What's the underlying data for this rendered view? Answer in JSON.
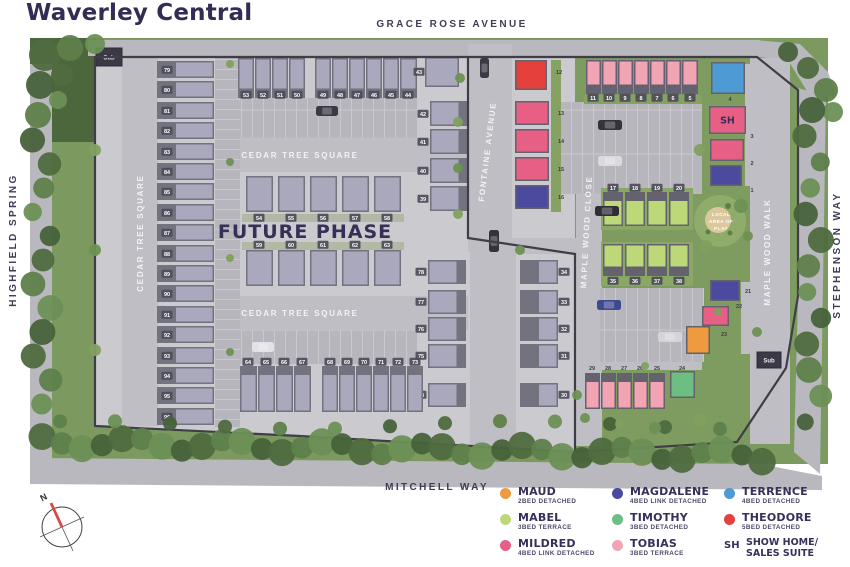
{
  "title": "Waverley Central",
  "streets": {
    "grace": "GRACE ROSE AVENUE",
    "highfield": "HIGHFIELD SPRING",
    "stephenson": "STEPHENSON WAY",
    "mitchell": "MITCHELL WAY",
    "fontaine": "FONTAINE AVENUE",
    "maple_close": "MAPLE WOOD CLOSE",
    "maple_walk": "MAPLE WOOD WALK",
    "cedar_top": "CEDAR TREE SQUARE",
    "cedar_bottom": "CEDAR TREE SQUARE",
    "cedar_left": "CEDAR TREE SQUARE"
  },
  "labels": {
    "future_phase": "FUTURE PHASE",
    "play_1": "LOCAL",
    "play_2": "AREA OF",
    "play_3": "PLAY",
    "sub": "Sub",
    "north": "N",
    "show_home": "SH"
  },
  "house_types": {
    "maud": "#EF9A3F",
    "mabel": "#BCD879",
    "mildred": "#E75F85",
    "magdalene": "#4B4A9E",
    "timothy": "#6DBE83",
    "tobias": "#F2A4B4",
    "terrence": "#4E9AD5",
    "theodore": "#E6403C",
    "showhome": "#E75F85",
    "future": "#A9A8BC"
  },
  "legend": {
    "items": [
      {
        "swatch": "#EF9A3F",
        "name": "MAUD",
        "desc": "2BED DETACHED"
      },
      {
        "swatch": "#BCD879",
        "name": "MABEL",
        "desc": "3BED TERRACE"
      },
      {
        "swatch": "#E75F85",
        "name": "MILDRED",
        "desc": "4BED LINK DETACHED"
      },
      {
        "swatch": "#4B4A9E",
        "name": "MAGDALENE",
        "desc": "4BED LINK DETACHED"
      },
      {
        "swatch": "#6DBE83",
        "name": "TIMOTHY",
        "desc": "3BED DETACHED"
      },
      {
        "swatch": "#F2A4B4",
        "name": "TOBIAS",
        "desc": "3BED TERRACE"
      },
      {
        "swatch": "#4E9AD5",
        "name": "TERRENCE",
        "desc": "4BED DETACHED"
      },
      {
        "swatch": "#E6403C",
        "name": "THEODORE",
        "desc": "5BED DETACHED"
      },
      {
        "symbol": "SH",
        "name": "SHOW HOME/",
        "name2": "SALES SUITE"
      }
    ]
  },
  "plots": [
    {
      "n": "12",
      "t": "theodore",
      "x": 515,
      "y": 60,
      "w": 32,
      "h": 30,
      "lx": 559,
      "ly": 74,
      "lc": "d"
    },
    {
      "n": "13",
      "t": "mildred",
      "x": 515,
      "y": 101,
      "w": 34,
      "h": 24,
      "lx": 561,
      "ly": 115,
      "lc": "d"
    },
    {
      "n": "14",
      "t": "mildred",
      "x": 515,
      "y": 129,
      "w": 34,
      "h": 24,
      "lx": 561,
      "ly": 143,
      "lc": "d"
    },
    {
      "n": "15",
      "t": "mildred",
      "x": 515,
      "y": 157,
      "w": 34,
      "h": 24,
      "lx": 561,
      "ly": 171,
      "lc": "d"
    },
    {
      "n": "16",
      "t": "magdalene",
      "x": 515,
      "y": 185,
      "w": 34,
      "h": 24,
      "lx": 561,
      "ly": 199,
      "lc": "d"
    },
    {
      "n": "11",
      "t": "tobias",
      "x": 586,
      "y": 60,
      "w": 15,
      "h": 34,
      "f": "s",
      "lx": 593,
      "ly": 100,
      "lc": "l"
    },
    {
      "n": "10",
      "t": "tobias",
      "x": 602,
      "y": 60,
      "w": 15,
      "h": 34,
      "f": "s",
      "lx": 609,
      "ly": 100,
      "lc": "l"
    },
    {
      "n": "9",
      "t": "tobias",
      "x": 618,
      "y": 60,
      "w": 15,
      "h": 34,
      "f": "s",
      "lx": 625,
      "ly": 100,
      "lc": "l"
    },
    {
      "n": "8",
      "t": "tobias",
      "x": 634,
      "y": 60,
      "w": 15,
      "h": 34,
      "f": "s",
      "lx": 641,
      "ly": 100,
      "lc": "l"
    },
    {
      "n": "7",
      "t": "tobias",
      "x": 650,
      "y": 60,
      "w": 15,
      "h": 34,
      "f": "s",
      "lx": 657,
      "ly": 100,
      "lc": "l"
    },
    {
      "n": "6",
      "t": "tobias",
      "x": 666,
      "y": 60,
      "w": 15,
      "h": 34,
      "f": "s",
      "lx": 673,
      "ly": 100,
      "lc": "l"
    },
    {
      "n": "5",
      "t": "tobias",
      "x": 682,
      "y": 60,
      "w": 16,
      "h": 34,
      "f": "s",
      "lx": 690,
      "ly": 100,
      "lc": "l"
    },
    {
      "n": "4",
      "t": "terrence",
      "x": 711,
      "y": 62,
      "w": 34,
      "h": 32,
      "lx": 730,
      "ly": 101,
      "lc": "d"
    },
    {
      "n": "3",
      "t": "showhome",
      "x": 709,
      "y": 106,
      "w": 37,
      "h": 28,
      "sh": 1,
      "lx": 752,
      "ly": 138,
      "lc": "d"
    },
    {
      "n": "2",
      "t": "mildred",
      "x": 710,
      "y": 139,
      "w": 34,
      "h": 22,
      "lx": 752,
      "ly": 165,
      "lc": "d"
    },
    {
      "n": "1",
      "t": "magdalene",
      "x": 710,
      "y": 165,
      "w": 32,
      "h": 21,
      "lx": 752,
      "ly": 192,
      "lc": "d"
    },
    {
      "n": "17",
      "t": "mabel",
      "x": 603,
      "y": 192,
      "w": 20,
      "h": 34,
      "f": "n",
      "lx": 613,
      "ly": 190,
      "lc": "l"
    },
    {
      "n": "18",
      "t": "mabel",
      "x": 625,
      "y": 192,
      "w": 20,
      "h": 34,
      "f": "n",
      "lx": 635,
      "ly": 190,
      "lc": "l"
    },
    {
      "n": "19",
      "t": "mabel",
      "x": 647,
      "y": 192,
      "w": 20,
      "h": 34,
      "f": "n",
      "lx": 657,
      "ly": 190,
      "lc": "l"
    },
    {
      "n": "20",
      "t": "mabel",
      "x": 669,
      "y": 192,
      "w": 20,
      "h": 34,
      "f": "n",
      "lx": 679,
      "ly": 190,
      "lc": "l"
    },
    {
      "n": "35",
      "t": "mabel",
      "x": 603,
      "y": 244,
      "w": 20,
      "h": 32,
      "f": "s",
      "lx": 613,
      "ly": 283,
      "lc": "l"
    },
    {
      "n": "36",
      "t": "mabel",
      "x": 625,
      "y": 244,
      "w": 20,
      "h": 32,
      "f": "s",
      "lx": 635,
      "ly": 283,
      "lc": "l"
    },
    {
      "n": "37",
      "t": "mabel",
      "x": 647,
      "y": 244,
      "w": 20,
      "h": 32,
      "f": "s",
      "lx": 657,
      "ly": 283,
      "lc": "l"
    },
    {
      "n": "38",
      "t": "mabel",
      "x": 669,
      "y": 244,
      "w": 20,
      "h": 32,
      "f": "s",
      "lx": 679,
      "ly": 283,
      "lc": "l"
    },
    {
      "n": "21",
      "t": "magdalene",
      "x": 710,
      "y": 280,
      "w": 30,
      "h": 21,
      "lx": 748,
      "ly": 293,
      "lc": "d"
    },
    {
      "n": "22",
      "t": "mildred",
      "x": 702,
      "y": 306,
      "w": 27,
      "h": 20,
      "lx": 739,
      "ly": 308,
      "lc": "d"
    },
    {
      "n": "23",
      "t": "maud",
      "x": 686,
      "y": 326,
      "w": 24,
      "h": 28,
      "lx": 724,
      "ly": 336,
      "lc": "d"
    },
    {
      "n": "24",
      "t": "timothy",
      "x": 670,
      "y": 371,
      "w": 25,
      "h": 27,
      "lx": 682,
      "ly": 370,
      "lc": "d"
    },
    {
      "n": "29",
      "t": "tobias",
      "x": 585,
      "y": 373,
      "w": 15,
      "h": 36,
      "f": "n",
      "lx": 592,
      "ly": 370,
      "lc": "d"
    },
    {
      "n": "28",
      "t": "tobias",
      "x": 601,
      "y": 373,
      "w": 15,
      "h": 36,
      "f": "n",
      "lx": 608,
      "ly": 370,
      "lc": "d"
    },
    {
      "n": "27",
      "t": "tobias",
      "x": 617,
      "y": 373,
      "w": 15,
      "h": 36,
      "f": "n",
      "lx": 624,
      "ly": 370,
      "lc": "d"
    },
    {
      "n": "26",
      "t": "tobias",
      "x": 633,
      "y": 373,
      "w": 15,
      "h": 36,
      "f": "n",
      "lx": 640,
      "ly": 370,
      "lc": "d"
    },
    {
      "n": "25",
      "t": "tobias",
      "x": 649,
      "y": 373,
      "w": 16,
      "h": 36,
      "f": "n",
      "lx": 657,
      "ly": 370,
      "lc": "d"
    },
    {
      "n": "79",
      "t": "future",
      "x": 157,
      "y": 61,
      "w": 57,
      "h": 17,
      "f": "w",
      "lx": 167,
      "ly": 72,
      "lc": "l"
    },
    {
      "n": "80",
      "t": "future",
      "x": 157,
      "y": 81,
      "w": 57,
      "h": 17,
      "f": "w",
      "lx": 167,
      "ly": 92,
      "lc": "l"
    },
    {
      "n": "81",
      "t": "future",
      "x": 157,
      "y": 102,
      "w": 57,
      "h": 17,
      "f": "w",
      "lx": 167,
      "ly": 113,
      "lc": "l"
    },
    {
      "n": "82",
      "t": "future",
      "x": 157,
      "y": 122,
      "w": 57,
      "h": 17,
      "f": "w",
      "lx": 167,
      "ly": 133,
      "lc": "l"
    },
    {
      "n": "83",
      "t": "future",
      "x": 157,
      "y": 143,
      "w": 57,
      "h": 17,
      "f": "w",
      "lx": 167,
      "ly": 154,
      "lc": "l"
    },
    {
      "n": "84",
      "t": "future",
      "x": 157,
      "y": 163,
      "w": 57,
      "h": 17,
      "f": "w",
      "lx": 167,
      "ly": 174,
      "lc": "l"
    },
    {
      "n": "85",
      "t": "future",
      "x": 157,
      "y": 183,
      "w": 57,
      "h": 17,
      "f": "w",
      "lx": 167,
      "ly": 194,
      "lc": "l"
    },
    {
      "n": "86",
      "t": "future",
      "x": 157,
      "y": 204,
      "w": 57,
      "h": 17,
      "f": "w",
      "lx": 167,
      "ly": 215,
      "lc": "l"
    },
    {
      "n": "87",
      "t": "future",
      "x": 157,
      "y": 224,
      "w": 57,
      "h": 17,
      "f": "w",
      "lx": 167,
      "ly": 235,
      "lc": "l"
    },
    {
      "n": "88",
      "t": "future",
      "x": 157,
      "y": 245,
      "w": 57,
      "h": 17,
      "f": "w",
      "lx": 167,
      "ly": 256,
      "lc": "l"
    },
    {
      "n": "89",
      "t": "future",
      "x": 157,
      "y": 265,
      "w": 57,
      "h": 17,
      "f": "w",
      "lx": 167,
      "ly": 276,
      "lc": "l"
    },
    {
      "n": "90",
      "t": "future",
      "x": 157,
      "y": 285,
      "w": 57,
      "h": 17,
      "f": "w",
      "lx": 167,
      "ly": 296,
      "lc": "l"
    },
    {
      "n": "91",
      "t": "future",
      "x": 157,
      "y": 306,
      "w": 57,
      "h": 17,
      "f": "w",
      "lx": 167,
      "ly": 317,
      "lc": "l"
    },
    {
      "n": "92",
      "t": "future",
      "x": 157,
      "y": 326,
      "w": 57,
      "h": 17,
      "f": "w",
      "lx": 167,
      "ly": 337,
      "lc": "l"
    },
    {
      "n": "93",
      "t": "future",
      "x": 157,
      "y": 347,
      "w": 57,
      "h": 17,
      "f": "w",
      "lx": 167,
      "ly": 358,
      "lc": "l"
    },
    {
      "n": "94",
      "t": "future",
      "x": 157,
      "y": 367,
      "w": 57,
      "h": 17,
      "f": "w",
      "lx": 167,
      "ly": 378,
      "lc": "l"
    },
    {
      "n": "95",
      "t": "future",
      "x": 157,
      "y": 387,
      "w": 57,
      "h": 17,
      "f": "w",
      "lx": 167,
      "ly": 398,
      "lc": "l"
    },
    {
      "n": "96",
      "t": "future",
      "x": 157,
      "y": 408,
      "w": 57,
      "h": 17,
      "f": "w",
      "lx": 167,
      "ly": 419,
      "lc": "l"
    },
    {
      "n": "53",
      "t": "future",
      "x": 238,
      "y": 58,
      "w": 16,
      "h": 40,
      "f": "s",
      "lx": 246,
      "ly": 97,
      "lc": "l"
    },
    {
      "n": "52",
      "t": "future",
      "x": 255,
      "y": 58,
      "w": 16,
      "h": 40,
      "f": "s",
      "lx": 263,
      "ly": 97,
      "lc": "l"
    },
    {
      "n": "51",
      "t": "future",
      "x": 272,
      "y": 58,
      "w": 16,
      "h": 40,
      "f": "s",
      "lx": 280,
      "ly": 97,
      "lc": "l"
    },
    {
      "n": "50",
      "t": "future",
      "x": 289,
      "y": 58,
      "w": 16,
      "h": 40,
      "f": "s",
      "lx": 297,
      "ly": 97,
      "lc": "l"
    },
    {
      "n": "49",
      "t": "future",
      "x": 315,
      "y": 58,
      "w": 16,
      "h": 40,
      "f": "s",
      "lx": 323,
      "ly": 97,
      "lc": "l"
    },
    {
      "n": "48",
      "t": "future",
      "x": 332,
      "y": 58,
      "w": 16,
      "h": 40,
      "f": "s",
      "lx": 340,
      "ly": 97,
      "lc": "l"
    },
    {
      "n": "47",
      "t": "future",
      "x": 349,
      "y": 58,
      "w": 16,
      "h": 40,
      "f": "s",
      "lx": 357,
      "ly": 97,
      "lc": "l"
    },
    {
      "n": "46",
      "t": "future",
      "x": 366,
      "y": 58,
      "w": 16,
      "h": 40,
      "f": "s",
      "lx": 374,
      "ly": 97,
      "lc": "l"
    },
    {
      "n": "45",
      "t": "future",
      "x": 383,
      "y": 58,
      "w": 16,
      "h": 40,
      "f": "s",
      "lx": 391,
      "ly": 97,
      "lc": "l"
    },
    {
      "n": "44",
      "t": "future",
      "x": 400,
      "y": 58,
      "w": 17,
      "h": 40,
      "f": "s",
      "lx": 408,
      "ly": 97,
      "lc": "l"
    },
    {
      "n": "43",
      "t": "future",
      "x": 425,
      "y": 57,
      "w": 34,
      "h": 30,
      "lx": 419,
      "ly": 74,
      "lc": "l"
    },
    {
      "n": "42",
      "t": "future",
      "x": 430,
      "y": 101,
      "w": 38,
      "h": 25,
      "f": "e",
      "lx": 423,
      "ly": 116,
      "lc": "l"
    },
    {
      "n": "41",
      "t": "future",
      "x": 430,
      "y": 129,
      "w": 38,
      "h": 25,
      "f": "e",
      "lx": 423,
      "ly": 144,
      "lc": "l"
    },
    {
      "n": "40",
      "t": "future",
      "x": 430,
      "y": 158,
      "w": 38,
      "h": 25,
      "f": "e",
      "lx": 423,
      "ly": 173,
      "lc": "l"
    },
    {
      "n": "39",
      "t": "future",
      "x": 430,
      "y": 186,
      "w": 38,
      "h": 25,
      "f": "e",
      "lx": 423,
      "ly": 201,
      "lc": "l"
    },
    {
      "n": "54",
      "t": "future",
      "x": 246,
      "y": 176,
      "w": 27,
      "h": 36,
      "lx": 259,
      "ly": 220,
      "lc": "l"
    },
    {
      "n": "55",
      "t": "future",
      "x": 278,
      "y": 176,
      "w": 27,
      "h": 36,
      "lx": 291,
      "ly": 220,
      "lc": "l"
    },
    {
      "n": "56",
      "t": "future",
      "x": 310,
      "y": 176,
      "w": 27,
      "h": 36,
      "lx": 323,
      "ly": 220,
      "lc": "l"
    },
    {
      "n": "57",
      "t": "future",
      "x": 342,
      "y": 176,
      "w": 27,
      "h": 36,
      "lx": 355,
      "ly": 220,
      "lc": "l"
    },
    {
      "n": "58",
      "t": "future",
      "x": 374,
      "y": 176,
      "w": 27,
      "h": 36,
      "lx": 387,
      "ly": 220,
      "lc": "l"
    },
    {
      "n": "59",
      "t": "future",
      "x": 246,
      "y": 250,
      "w": 27,
      "h": 36,
      "lx": 259,
      "ly": 247,
      "lc": "l"
    },
    {
      "n": "60",
      "t": "future",
      "x": 278,
      "y": 250,
      "w": 27,
      "h": 36,
      "lx": 291,
      "ly": 247,
      "lc": "l"
    },
    {
      "n": "61",
      "t": "future",
      "x": 310,
      "y": 250,
      "w": 27,
      "h": 36,
      "lx": 323,
      "ly": 247,
      "lc": "l"
    },
    {
      "n": "62",
      "t": "future",
      "x": 342,
      "y": 250,
      "w": 27,
      "h": 36,
      "lx": 355,
      "ly": 247,
      "lc": "l"
    },
    {
      "n": "63",
      "t": "future",
      "x": 374,
      "y": 250,
      "w": 27,
      "h": 36,
      "lx": 387,
      "ly": 247,
      "lc": "l"
    },
    {
      "n": "78",
      "t": "future",
      "x": 428,
      "y": 260,
      "w": 38,
      "h": 24,
      "f": "e",
      "lx": 421,
      "ly": 274,
      "lc": "l"
    },
    {
      "n": "77",
      "t": "future",
      "x": 428,
      "y": 290,
      "w": 38,
      "h": 24,
      "f": "e",
      "lx": 421,
      "ly": 304,
      "lc": "l"
    },
    {
      "n": "76",
      "t": "future",
      "x": 428,
      "y": 317,
      "w": 38,
      "h": 24,
      "f": "e",
      "lx": 421,
      "ly": 331,
      "lc": "l"
    },
    {
      "n": "75",
      "t": "future",
      "x": 428,
      "y": 344,
      "w": 38,
      "h": 24,
      "f": "e",
      "lx": 421,
      "ly": 358,
      "lc": "l"
    },
    {
      "n": "74",
      "t": "future",
      "x": 428,
      "y": 383,
      "w": 38,
      "h": 24,
      "f": "e",
      "lx": 421,
      "ly": 397,
      "lc": "l"
    },
    {
      "n": "34",
      "t": "future",
      "x": 520,
      "y": 260,
      "w": 38,
      "h": 24,
      "f": "w",
      "lx": 564,
      "ly": 274,
      "lc": "l"
    },
    {
      "n": "33",
      "t": "future",
      "x": 520,
      "y": 290,
      "w": 38,
      "h": 24,
      "f": "w",
      "lx": 564,
      "ly": 304,
      "lc": "l"
    },
    {
      "n": "32",
      "t": "future",
      "x": 520,
      "y": 317,
      "w": 38,
      "h": 24,
      "f": "w",
      "lx": 564,
      "ly": 331,
      "lc": "l"
    },
    {
      "n": "31",
      "t": "future",
      "x": 520,
      "y": 344,
      "w": 38,
      "h": 24,
      "f": "w",
      "lx": 564,
      "ly": 358,
      "lc": "l"
    },
    {
      "n": "30",
      "t": "future",
      "x": 520,
      "y": 383,
      "w": 38,
      "h": 24,
      "f": "w",
      "lx": 564,
      "ly": 397,
      "lc": "l"
    },
    {
      "n": "64",
      "t": "future",
      "x": 240,
      "y": 366,
      "w": 17,
      "h": 46,
      "f": "n",
      "lx": 248,
      "ly": 364,
      "lc": "l"
    },
    {
      "n": "65",
      "t": "future",
      "x": 258,
      "y": 366,
      "w": 17,
      "h": 46,
      "f": "n",
      "lx": 266,
      "ly": 364,
      "lc": "l"
    },
    {
      "n": "66",
      "t": "future",
      "x": 276,
      "y": 366,
      "w": 17,
      "h": 46,
      "f": "n",
      "lx": 284,
      "ly": 364,
      "lc": "l"
    },
    {
      "n": "67",
      "t": "future",
      "x": 294,
      "y": 366,
      "w": 17,
      "h": 46,
      "f": "n",
      "lx": 302,
      "ly": 364,
      "lc": "l"
    },
    {
      "n": "68",
      "t": "future",
      "x": 322,
      "y": 366,
      "w": 16,
      "h": 46,
      "f": "n",
      "lx": 330,
      "ly": 364,
      "lc": "l"
    },
    {
      "n": "69",
      "t": "future",
      "x": 339,
      "y": 366,
      "w": 16,
      "h": 46,
      "f": "n",
      "lx": 347,
      "ly": 364,
      "lc": "l"
    },
    {
      "n": "70",
      "t": "future",
      "x": 356,
      "y": 366,
      "w": 16,
      "h": 46,
      "f": "n",
      "lx": 364,
      "ly": 364,
      "lc": "l"
    },
    {
      "n": "71",
      "t": "future",
      "x": 373,
      "y": 366,
      "w": 16,
      "h": 46,
      "f": "n",
      "lx": 381,
      "ly": 364,
      "lc": "l"
    },
    {
      "n": "72",
      "t": "future",
      "x": 390,
      "y": 366,
      "w": 16,
      "h": 46,
      "f": "n",
      "lx": 398,
      "ly": 364,
      "lc": "l"
    },
    {
      "n": "73",
      "t": "future",
      "x": 407,
      "y": 366,
      "w": 16,
      "h": 46,
      "f": "n",
      "lx": 415,
      "ly": 364,
      "lc": "l"
    }
  ],
  "cars": [
    {
      "x": 598,
      "y": 120,
      "w": 24,
      "h": 10,
      "c": "#33333C"
    },
    {
      "x": 598,
      "y": 156,
      "w": 24,
      "h": 10,
      "c": "#DADADE"
    },
    {
      "x": 595,
      "y": 206,
      "w": 24,
      "h": 10,
      "c": "#2E2E37"
    },
    {
      "x": 597,
      "y": 300,
      "w": 24,
      "h": 10,
      "c": "#3D4A8F"
    },
    {
      "x": 658,
      "y": 332,
      "w": 24,
      "h": 10,
      "c": "#D5D5D9"
    },
    {
      "x": 489,
      "y": 230,
      "w": 10,
      "h": 22,
      "c": "#33333C"
    },
    {
      "x": 480,
      "y": 58,
      "w": 9,
      "h": 20,
      "c": "#3A3A44"
    },
    {
      "x": 252,
      "y": 342,
      "w": 22,
      "h": 10,
      "c": "#E2E2E5"
    },
    {
      "x": 316,
      "y": 106,
      "w": 22,
      "h": 10,
      "c": "#3A3A44"
    }
  ],
  "sub_stations": [
    {
      "x": 96,
      "y": 48,
      "w": 26,
      "h": 18
    },
    {
      "x": 757,
      "y": 352,
      "w": 24,
      "h": 16
    }
  ]
}
